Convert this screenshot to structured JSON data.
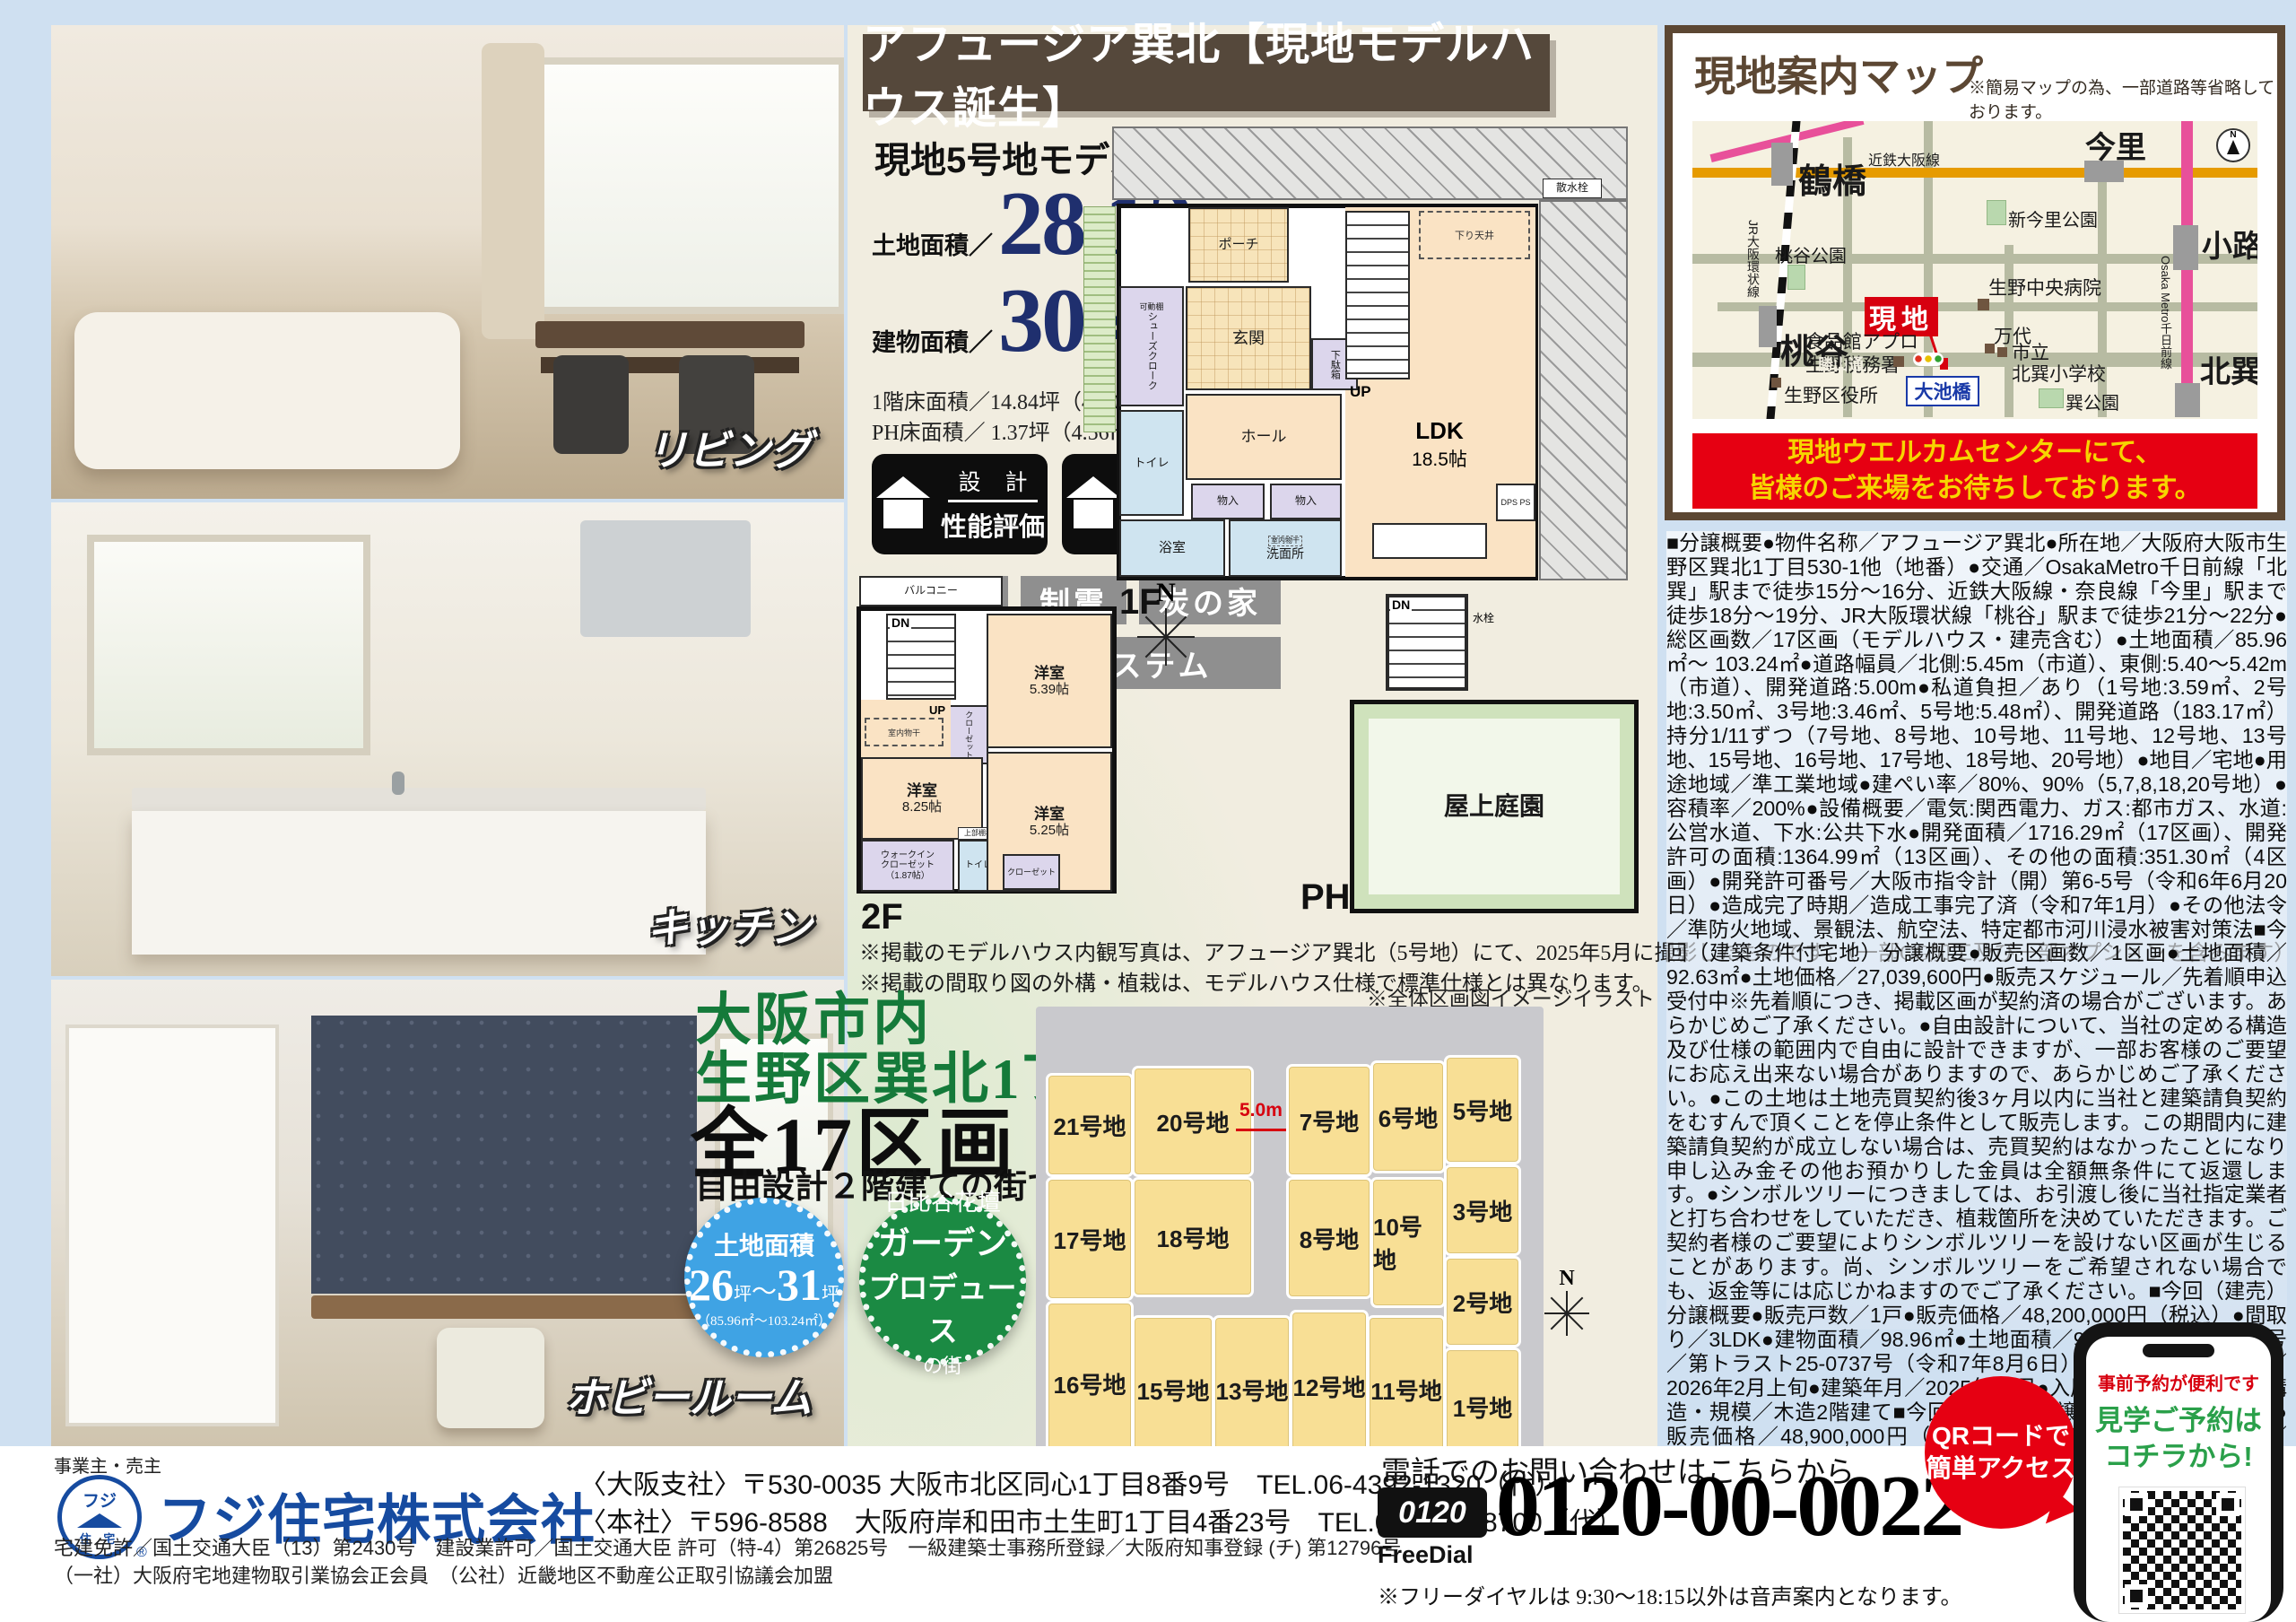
{
  "banner": {
    "text": "アフュージア巽北【現地モデルハウス誕生】"
  },
  "model": {
    "heading": "現地5号地モデルハウス",
    "land_label": "土地面積／",
    "land_num": "28.12",
    "land_unit": "坪",
    "land_m2": "（92.97㎡）",
    "bldg_label": "建物面積／",
    "bldg_num": "30.43",
    "bldg_unit": "坪",
    "bldg_m2": "（100.62㎡）",
    "floors1": "1階床面積／14.84坪（49.07㎡）　2階床面積／14.21坪（46.99㎡）",
    "floors2": "PH床面積／ 1.37坪（4.56㎡）",
    "b1top": "設 計",
    "b1bot": "性能評価",
    "b2top": "建 設",
    "b2bot": "性能評価",
    "tags": [
      "耐震3",
      "制震",
      "炭の家"
    ],
    "tag_wide": "全熱交換システム"
  },
  "plan1f": {
    "label": "1F",
    "porch": "ポーチ",
    "genkan": "玄関",
    "shoes": "シューズクローク",
    "kadoudana": "可動棚",
    "getabako": "下駄箱",
    "up": "UP",
    "sagari": "下り天井",
    "ldk": "LDK",
    "ldk_size": "18.5帖",
    "hall": "ホール",
    "toilet": "トイレ",
    "mono1": "物入",
    "mono2": "物入",
    "dps": "DPS PS",
    "bath": "浴室",
    "wash": "洗面所",
    "monohoshi": "室内物干",
    "sansui": "散水栓"
  },
  "plan2f": {
    "label": "2F",
    "balcony": "バルコニー",
    "dn": "DN",
    "up": "UP",
    "room1": "洋室",
    "room1_size": "5.39帖",
    "closet1": "クローゼット",
    "monohoshi": "室内物干",
    "room2": "洋室",
    "room2_size": "8.25帖",
    "wic1": "ウォークイン",
    "wic2": "クローゼット",
    "wic3": "（1.87帖）",
    "shelf": "上部棚板",
    "toilet": "トイレ",
    "room3": "洋室",
    "room3_size": "5.25帖",
    "closet2": "クローゼット"
  },
  "planph": {
    "label": "PH",
    "dn": "DN",
    "suisen": "水栓",
    "garden": "屋上庭園"
  },
  "compass_mid": "N",
  "notes": {
    "line1": "※掲載のモデルハウス内観写真は、アフュージア巽北（5号地）にて、2025年5月に撮影したものです。（一部CG加工及び一部オプションを含みます）",
    "line2": "※掲載の間取り図の外構・植栽は、モデルハウス仕様で標準仕様とは異なります。"
  },
  "promo": {
    "line1": "大阪市内",
    "line2": "生野区巽北1丁目",
    "big": "全17区画",
    "sub": "自由設計２階建ての街で登場！",
    "blue": {
      "t1": "土地面積",
      "n1": "26",
      "u1": "坪",
      "tl": "〜",
      "n2": "31",
      "u2": "坪",
      "t3": "（85.96㎡〜103.24㎡）"
    },
    "green": {
      "t1": "日比谷花壇",
      "t2": "ガーデン",
      "t3": "プロデュース",
      "t4": "の街"
    }
  },
  "siteplan": {
    "caption": "※全体区画図イメージイラスト",
    "road": "5.0m",
    "compass": "N",
    "lots": [
      "21号地",
      "20号地",
      "7号地",
      "6号地",
      "5号地",
      "17号地",
      "18号地",
      "8号地",
      "10号地",
      "3号地",
      "2号地",
      "16号地",
      "15号地",
      "13号地",
      "12号地",
      "11号地",
      "1号地"
    ]
  },
  "map": {
    "title": "現地案内マップ",
    "note": "※簡易マップの為、一部道路等省略しております。",
    "banner1": "現地ウエルカムセンターにて、",
    "banner2": "皆様のご来場をお待ちしております。",
    "imazato": "今里",
    "tsuruhashi": "鶴橋",
    "momodani": "桃谷",
    "shoji": "小路",
    "kitatatsumi": "北巽",
    "kintetsu": "近鉄大阪線",
    "jr": "JR大阪環状線",
    "metro": "Osaka Metro千日前線",
    "park_shinimazato": "新今里公園",
    "park_momodani": "桃谷公園",
    "park_tatsumi": "巽公園",
    "hospital": "生野中央病院",
    "genchi": "現地",
    "appro": "食品館アプロ",
    "zeimusho": "生野税務署",
    "mandai": "万代",
    "school1": "市立",
    "school2": "北巽小学校",
    "kuyakusho": "生野区役所",
    "oikebashi": "大池橋",
    "katsuyama": "勝山通",
    "compass": "N"
  },
  "legal": {
    "text": "■分譲概要●物件名称／アフュージア巽北●所在地／大阪府大阪市生野区巽北1丁目530-1他（地番）●交通／OsakaMetro千日前線「北巽」駅まで徒歩15分〜16分、近鉄大阪線・奈良線「今里」駅まで徒歩18分〜19分、JR大阪環状線「桃谷」駅まで徒歩21分〜22分●総区画数／17区画（モデルハウス・建売含む）●土地面積／85.96㎡〜 103.24㎡●道路幅員／北側:5.45m（市道）、東側:5.40〜5.42m（市道）、開発道路:5.00m●私道負担／あり（1号地:3.59㎡、2号地:3.50㎡、3号地:3.46㎡、5号地:5.48㎡）、開発道路（183.17㎡）持分1/11ずつ（7号地、8号地、10号地、11号地、12号地、13号地、15号地、16号地、17号地、18号地、20号地）●地目／宅地●用途地域／準工業地域●建ぺい率／80%、90%（5,7,8,18,20号地）●容積率／200%●設備概要／電気:関西電力、ガス:都市ガス、水道:公営水道、下水:公共下水●開発面積／1716.29㎡（17区画）、開発許可の面積:1364.99㎡（13区画）、その他の面積:351.30㎡（4区画）●開発許可番号／大阪市指令計（開）第6-5号（令和6年6月20日）●造成完了時期／造成工事完了済（令和7年1月）●その他法令／準防火地域、景観法、航空法、特定都市河川浸水被害対策法■今回（建築条件付宅地）分譲概要●販売区画数／1区画●土地面積／92.63㎡●土地価格／27,039,600円●販売スケジュール／先着順申込受付中※先着順につき、掲載区画が契約済の場合がございます。あらかじめご了承ください。●自由設計について、当社の定める構造及び仕様の範囲内で自由に設計できますが、一部お客様のご要望にお応え出来ない場合がありますので、あらかじめご了承ください。●この土地は土地売買契約後3ヶ月以内に当社と建築請負契約をむすんで頂くことを停止条件として販売します。この期間内に建築請負契約が成立しない場合は、売買契約はなかったことになり申し込み金その他お預かりした金員は全額無条件にて返還します。●シンボルツリーにつきましては、お引渡し後に当社指定業者と打ち合わせをしていただき、植栽箇所を決めていただきます。ご契約者様のご要望によりシンボルツリーを設けない区画が生じることがあります。尚、シンボルツリーをご希望されない場合でも、返金等には応じかねますのでご了承ください。■今回（建売）分譲概要●販売戸数／1戸●販売価格／48,200,000円（税込）●間取り／3LDK●建物面積／98.96㎡●土地面積／94.98㎡●建築確認番号／第トラスト25-0737号（令和7年8月6日）●販売スケジュール／2026年2月上旬●建築年月／2025年12月●入居時期／2026年4月●構造・規模／木造2階建て■今回（建売）分譲概要●販売戸数／1戸●販売価格／48,900,000円（税込）●間取り／3LDK●建物面積／92.97㎡●土地面積／88.90㎡●建築確認番号／第トラスト25-0738号（令和7年8月6日）●販売スケジュール／先着順申込受付中※先着順につき、掲載区画が契約済の場合がございます。あらかじめご了承ください。●建築年月／2026年1月●入居時期／2026年4月●構造・規模／木造2階建て【共通概要】●モデルハウス販売は、現状有姿となります。現地にて、付帯設備・家具等を係員にお問い合わせ、お確かめ下さい。家電・家具等は商品購入時の保証となります。あらかじめご了承下さい。●売主／フジ住宅株式会社●諸費用／自治会費、登記費用、並びに住宅ローンご利用の方は利用するローンの規定と利用形態に応じた保証料・事務手数料及び火災保険料等が必要になります。●掲載の徒歩所要分数は、物件を起点として1分80mで計算しております。●取引条件有効期限／2026年2月末日※当資料は2026年1月28日現在のものです。※最新の情報はホームページ等にてご確認ください。"
  },
  "photos": {
    "living": "リビング",
    "kitchen": "キッチン",
    "hobby": "ホビールーム"
  },
  "company": {
    "role": "事業主・売主",
    "logo1": "フジ",
    "logo2": "住 宅",
    "reg": "®",
    "name": "フジ住宅株式会社",
    "addr1": "〈大阪支社〉〒530-0035 大阪市北区同心1丁目8番9号　TEL.06-4392-1320（代）",
    "addr2": "〈本社〉〒596-8588　大阪府岸和田市土生町1丁目4番23号　TEL.072-437-8700（代）",
    "lic1": "宅建免許／国土交通大臣（13）第2430号　建設業許可／国土交通大臣 許可（特-4）第26825号　一級建築士事務所登録／大阪府知事登録 (チ) 第12796号",
    "lic2": "（一社）大阪府宅地建物取引業協会正会員　（公社）近畿地区不動産公正取引協議会加盟"
  },
  "phone": {
    "lead": "電話でのお問い合わせはこちらから",
    "dial": "0120",
    "dial_label": "FreeDial",
    "number": "0120-00-0022",
    "note": "※フリーダイヤルは 9:30〜18:15以外は音声案内となります。"
  },
  "qr": {
    "bubble1": "QRコードで",
    "bubble2": "簡単アクセス",
    "s1": "事前予約が便利です",
    "s2": "見学ご予約は",
    "s3": "コチラから!"
  }
}
